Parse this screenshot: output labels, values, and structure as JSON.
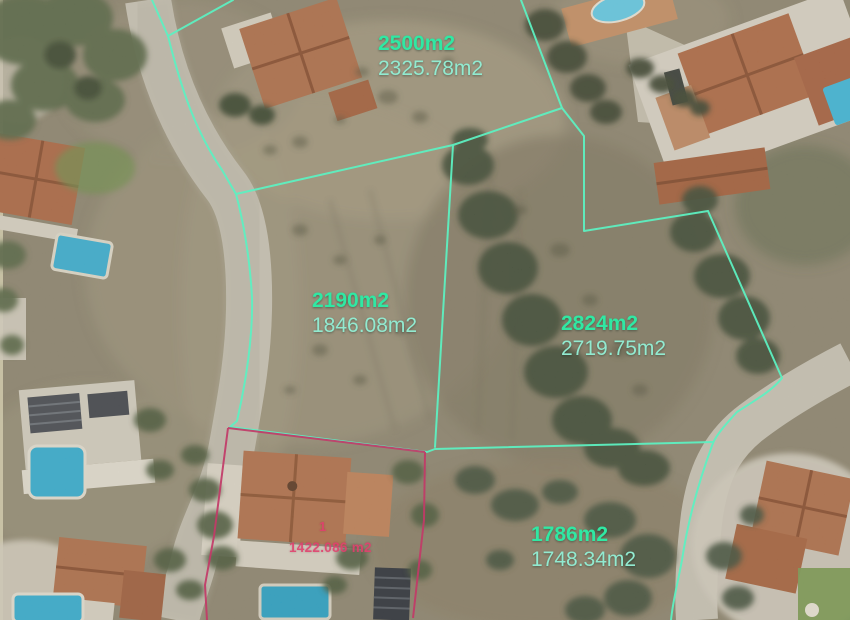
{
  "colors": {
    "boundary": "#5df0c1",
    "label-primary": "#30e8a3",
    "label-secondary": "#92ead0",
    "highlight": "#c23a68",
    "highlight-text": "#e0406e"
  },
  "parcels": [
    {
      "area_label": "2500m2",
      "measured_label": "2325.78m2"
    },
    {
      "area_label": "2190m2",
      "measured_label": "1846.08m2"
    },
    {
      "area_label": "2824m2",
      "measured_label": "2719.75m2"
    },
    {
      "area_label": "1786m2",
      "measured_label": "1748.34m2"
    }
  ],
  "highlight_parcel": {
    "number": "1",
    "area_label": "1422.086 m2"
  }
}
